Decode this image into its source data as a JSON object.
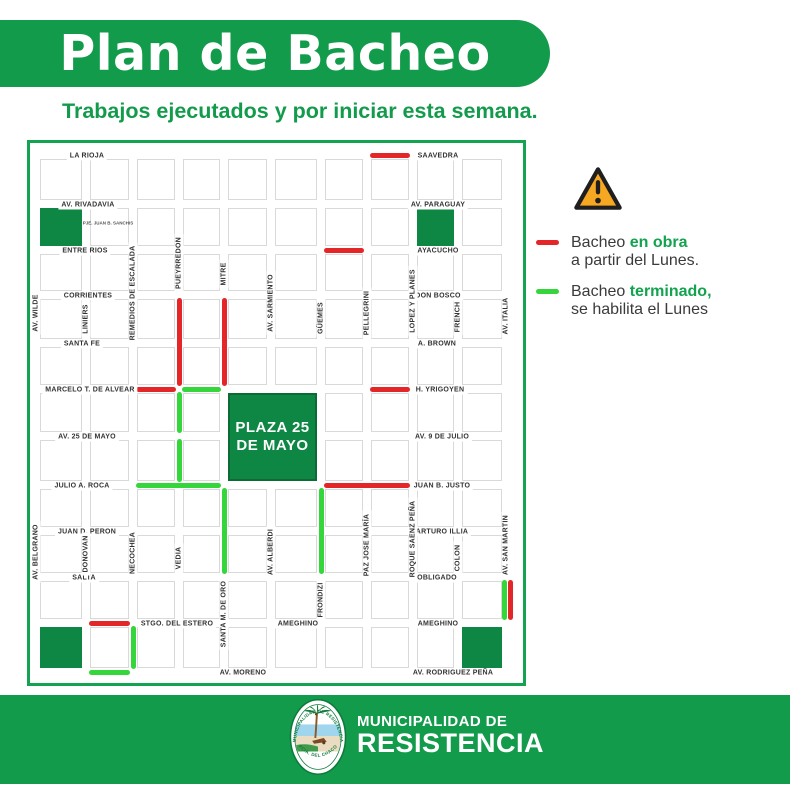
{
  "header": {
    "title": "Plan de Bacheo",
    "subtitle": "Trabajos ejecutados y por iniciar esta semana."
  },
  "legend": {
    "warning_icon": "warning-triangle-icon",
    "items": [
      {
        "key": "en-obra",
        "prefix": "Bacheo ",
        "highlight": "en obra",
        "line2": "a partir del Lunes.",
        "color": "#e52628"
      },
      {
        "key": "terminado",
        "prefix": "Bacheo ",
        "highlight": "terminado,",
        "line2": "se habilita el Lunes",
        "color": "#35d63b"
      }
    ]
  },
  "map": {
    "plaza": {
      "line1": "PLAZA 25",
      "line2": "DE MAYO",
      "cell": {
        "c": 4,
        "r": 5,
        "w": 2,
        "h": 2
      }
    },
    "passage": {
      "label": "PJE. JUAN B. SANCHIS",
      "x": 78,
      "y": 80
    },
    "green_blocks": [
      {
        "c": 0,
        "r": 1
      },
      {
        "c": 8,
        "r": 1
      },
      {
        "c": 0,
        "r": 10
      },
      {
        "c": 9,
        "r": 10
      }
    ],
    "h_streets": [
      {
        "label": "LA RIOJA",
        "row": 0,
        "cx": 57
      },
      {
        "label": "SAAVEDRA",
        "row": 0,
        "cx": 408
      },
      {
        "label": "AV. RIVADAVIA",
        "row": 1,
        "cx": 58
      },
      {
        "label": "AV. PARAGUAY",
        "row": 1,
        "cx": 408
      },
      {
        "label": "ENTRE RIOS",
        "row": 2,
        "cx": 55
      },
      {
        "label": "AYACUCHO",
        "row": 2,
        "cx": 408
      },
      {
        "label": "CORRIENTES",
        "row": 3,
        "cx": 58
      },
      {
        "label": "DON BOSCO",
        "row": 3,
        "cx": 408
      },
      {
        "label": "SANTA FE",
        "row": 4,
        "cx": 52
      },
      {
        "label": "A. BROWN",
        "row": 4,
        "cx": 407
      },
      {
        "label": "MARCELO T. DE ALVEAR",
        "row": 5,
        "cx": 60
      },
      {
        "label": "H. YRIGOYEN",
        "row": 5,
        "cx": 410
      },
      {
        "label": "AV. 25 DE MAYO",
        "row": 6,
        "cx": 57
      },
      {
        "label": "AV. 9 DE JULIO",
        "row": 6,
        "cx": 412
      },
      {
        "label": "JULIO A. ROCA",
        "row": 7,
        "cx": 52
      },
      {
        "label": "JUAN B. JUSTO",
        "row": 7,
        "cx": 412
      },
      {
        "label": "JUAN D. PERON",
        "row": 8,
        "cx": 57
      },
      {
        "label": "ARTURO ILLIA",
        "row": 8,
        "cx": 412
      },
      {
        "label": "SALTA",
        "row": 9,
        "cx": 54
      },
      {
        "label": "OBLIGADO",
        "row": 9,
        "cx": 407
      },
      {
        "label": "STGO. DEL ESTERO",
        "row": 10,
        "cx": 147
      },
      {
        "label": "AMEGHINO",
        "row": 10,
        "cx": 268
      },
      {
        "label": "AMEGHINO",
        "row": 10,
        "cx": 408
      },
      {
        "label": "AV. MORENO",
        "row": 11,
        "cx": 213
      },
      {
        "label": "AV. RODRIGUEZ PEÑA",
        "row": 11,
        "cx": 423
      }
    ],
    "v_streets": [
      {
        "label": "AV. WILDE",
        "col": 0,
        "cy": 170
      },
      {
        "label": "LINIERS",
        "col": 1,
        "cy": 176
      },
      {
        "label": "REMEDIOS DE ESCALADA",
        "col": 2,
        "cy": 150
      },
      {
        "label": "PUEYRREDON",
        "col": 3,
        "cy": 120
      },
      {
        "label": "MITRE",
        "col": 4,
        "cy": 131
      },
      {
        "label": "AV. SARMIENTO",
        "col": 5,
        "cy": 160
      },
      {
        "label": "GÜEMES",
        "col": 6,
        "cy": 175
      },
      {
        "label": "PELLEGRINI",
        "col": 7,
        "cy": 170
      },
      {
        "label": "LOPEZ Y PLANES",
        "col": 8,
        "cy": 158
      },
      {
        "label": "FRENCH",
        "col": 9,
        "cy": 174
      },
      {
        "label": "AV. ITALIA",
        "col": 10,
        "cy": 173
      },
      {
        "label": "AV. BELGRANO",
        "col": 0,
        "cy": 409
      },
      {
        "label": "DONOVAN",
        "col": 1,
        "cy": 411
      },
      {
        "label": "NECOCHEA",
        "col": 2,
        "cy": 410
      },
      {
        "label": "VEDIA",
        "col": 3,
        "cy": 415
      },
      {
        "label": "SANTA M. DE ORO",
        "col": 4,
        "cy": 471
      },
      {
        "label": "AV. ALBERDI",
        "col": 5,
        "cy": 409
      },
      {
        "label": "FRONDIZI",
        "col": 6,
        "cy": 457
      },
      {
        "label": "PAZ JOSE MARÍA",
        "col": 7,
        "cy": 402
      },
      {
        "label": "ROQUE SAENZ PEÑA",
        "col": 8,
        "cy": 396
      },
      {
        "label": "COLON",
        "col": 9,
        "cy": 415
      },
      {
        "label": "AV. SAN MARTIN",
        "col": 10,
        "cy": 402
      }
    ],
    "segments": [
      {
        "color": "red",
        "dir": "h",
        "at": 0,
        "from": 7,
        "to": 8
      },
      {
        "color": "red",
        "dir": "h",
        "at": 2,
        "from": 6,
        "to": 7
      },
      {
        "color": "red",
        "dir": "v",
        "at": 3,
        "from": 3,
        "to": 5
      },
      {
        "color": "red",
        "dir": "v",
        "at": 4,
        "from": 3,
        "to": 5
      },
      {
        "color": "red",
        "dir": "h",
        "at": 5,
        "from": 2,
        "to": 3
      },
      {
        "color": "green",
        "dir": "h",
        "at": 5,
        "from": 3,
        "to": 4
      },
      {
        "color": "red",
        "dir": "h",
        "at": 5,
        "from": 7,
        "to": 8
      },
      {
        "color": "green",
        "dir": "v",
        "at": 3,
        "from": 5,
        "to": 6
      },
      {
        "color": "green",
        "dir": "v",
        "at": 3,
        "from": 6,
        "to": 7
      },
      {
        "color": "green",
        "dir": "h",
        "at": 7,
        "from": 2,
        "to": 4
      },
      {
        "color": "red",
        "dir": "h",
        "at": 7,
        "from": 6,
        "to": 8
      },
      {
        "color": "green",
        "dir": "v",
        "at": 4,
        "from": 7,
        "to": 9
      },
      {
        "color": "green",
        "dir": "v",
        "at": 6,
        "from": 7,
        "to": 9
      },
      {
        "color": "red",
        "dir": "h",
        "at": 10,
        "from": 1,
        "to": 2
      },
      {
        "color": "green",
        "dir": "v",
        "at": 2,
        "from": 10,
        "to": 11
      },
      {
        "color": "green",
        "dir": "h",
        "at": 11,
        "from": 1,
        "to": 2
      },
      {
        "color": "green",
        "dir": "v",
        "at": 10,
        "from": 9,
        "to": 10,
        "offset": -2
      },
      {
        "color": "red",
        "dir": "v",
        "at": 10,
        "from": 9,
        "to": 10,
        "offset": 4
      }
    ]
  },
  "footer": {
    "org_line1": "MUNICIPALIDAD DE",
    "org_line2": "RESISTENCIA",
    "seal_top_text": "MUNICIPALIDAD DE RESISTENCIA",
    "seal_bottom_text": "PCIA. DEL CHACO"
  },
  "colors": {
    "brand_green": "#129b4b",
    "block_green": "#0d8743",
    "line_green": "#35d63b",
    "line_red": "#e52628",
    "warning_orange": "#f7a823",
    "text_dark": "#3b3b3b"
  }
}
